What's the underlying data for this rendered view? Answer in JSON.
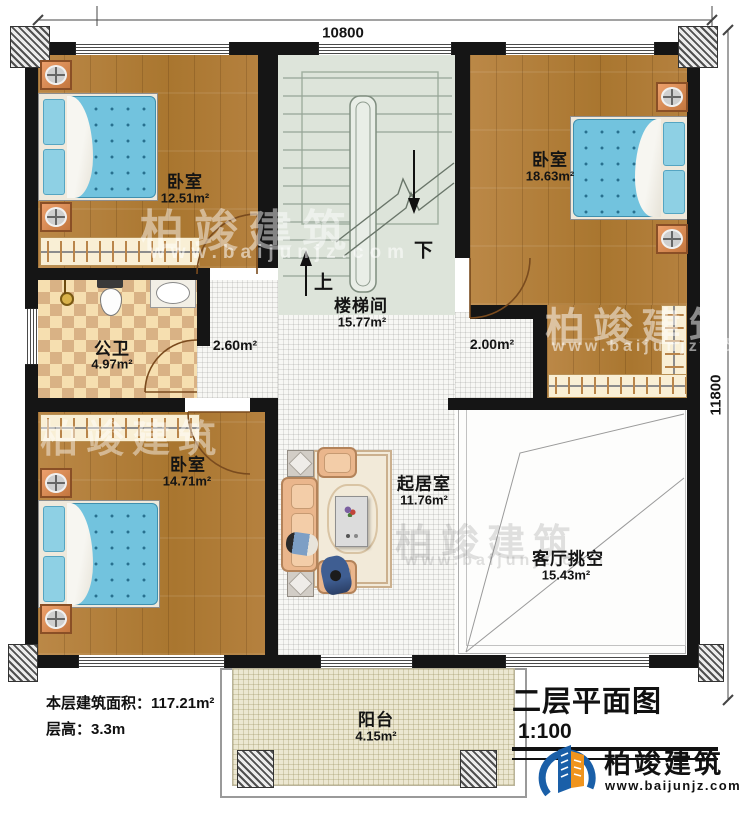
{
  "dimensions": {
    "top": "10800",
    "right": "11800"
  },
  "rooms": {
    "bedroom_tl": {
      "name": "卧室",
      "area": "12.51m²"
    },
    "bedroom_tr": {
      "name": "卧室",
      "area": "18.63m²"
    },
    "bedroom_bl": {
      "name": "卧室",
      "area": "14.71m²"
    },
    "stairwell": {
      "name": "楼梯间",
      "area": "15.77m²"
    },
    "bathroom": {
      "name": "公卫",
      "area": "4.97m²"
    },
    "living": {
      "name": "起居室",
      "area": "11.76m²"
    },
    "void": {
      "name": "客厅挑空",
      "area": "15.43m²"
    },
    "balcony": {
      "name": "阳台",
      "area": "4.15m²"
    },
    "hall_left_area": "2.60m²",
    "hall_right_area": "2.00m²"
  },
  "stairs": {
    "up": "上",
    "down": "下"
  },
  "info": {
    "floor_area_label": "本层建筑面积：",
    "floor_area_value": "117.21m²",
    "floor_height_label": "层高：",
    "floor_height_value": "3.3m"
  },
  "title_block": {
    "title": "二层平面图",
    "scale": "1:100"
  },
  "logo": {
    "name": "柏竣建筑",
    "url": "www.baijunjz.com"
  },
  "watermark": {
    "text": "柏竣建筑",
    "url": "www.baijunjz.com"
  },
  "colors": {
    "wall": "#151515",
    "wood": "#b5813f",
    "stair_floor": "#dde4da",
    "tile": "#f7f7f4",
    "bath_light": "#f6dfb0",
    "bath_dark": "#d9b285",
    "balcony": "#ece7d1",
    "bed_blue": "#72c3de",
    "sofa": "#eab68c",
    "logo_blue": "#1a5fa8",
    "logo_orange": "#f0941d"
  }
}
